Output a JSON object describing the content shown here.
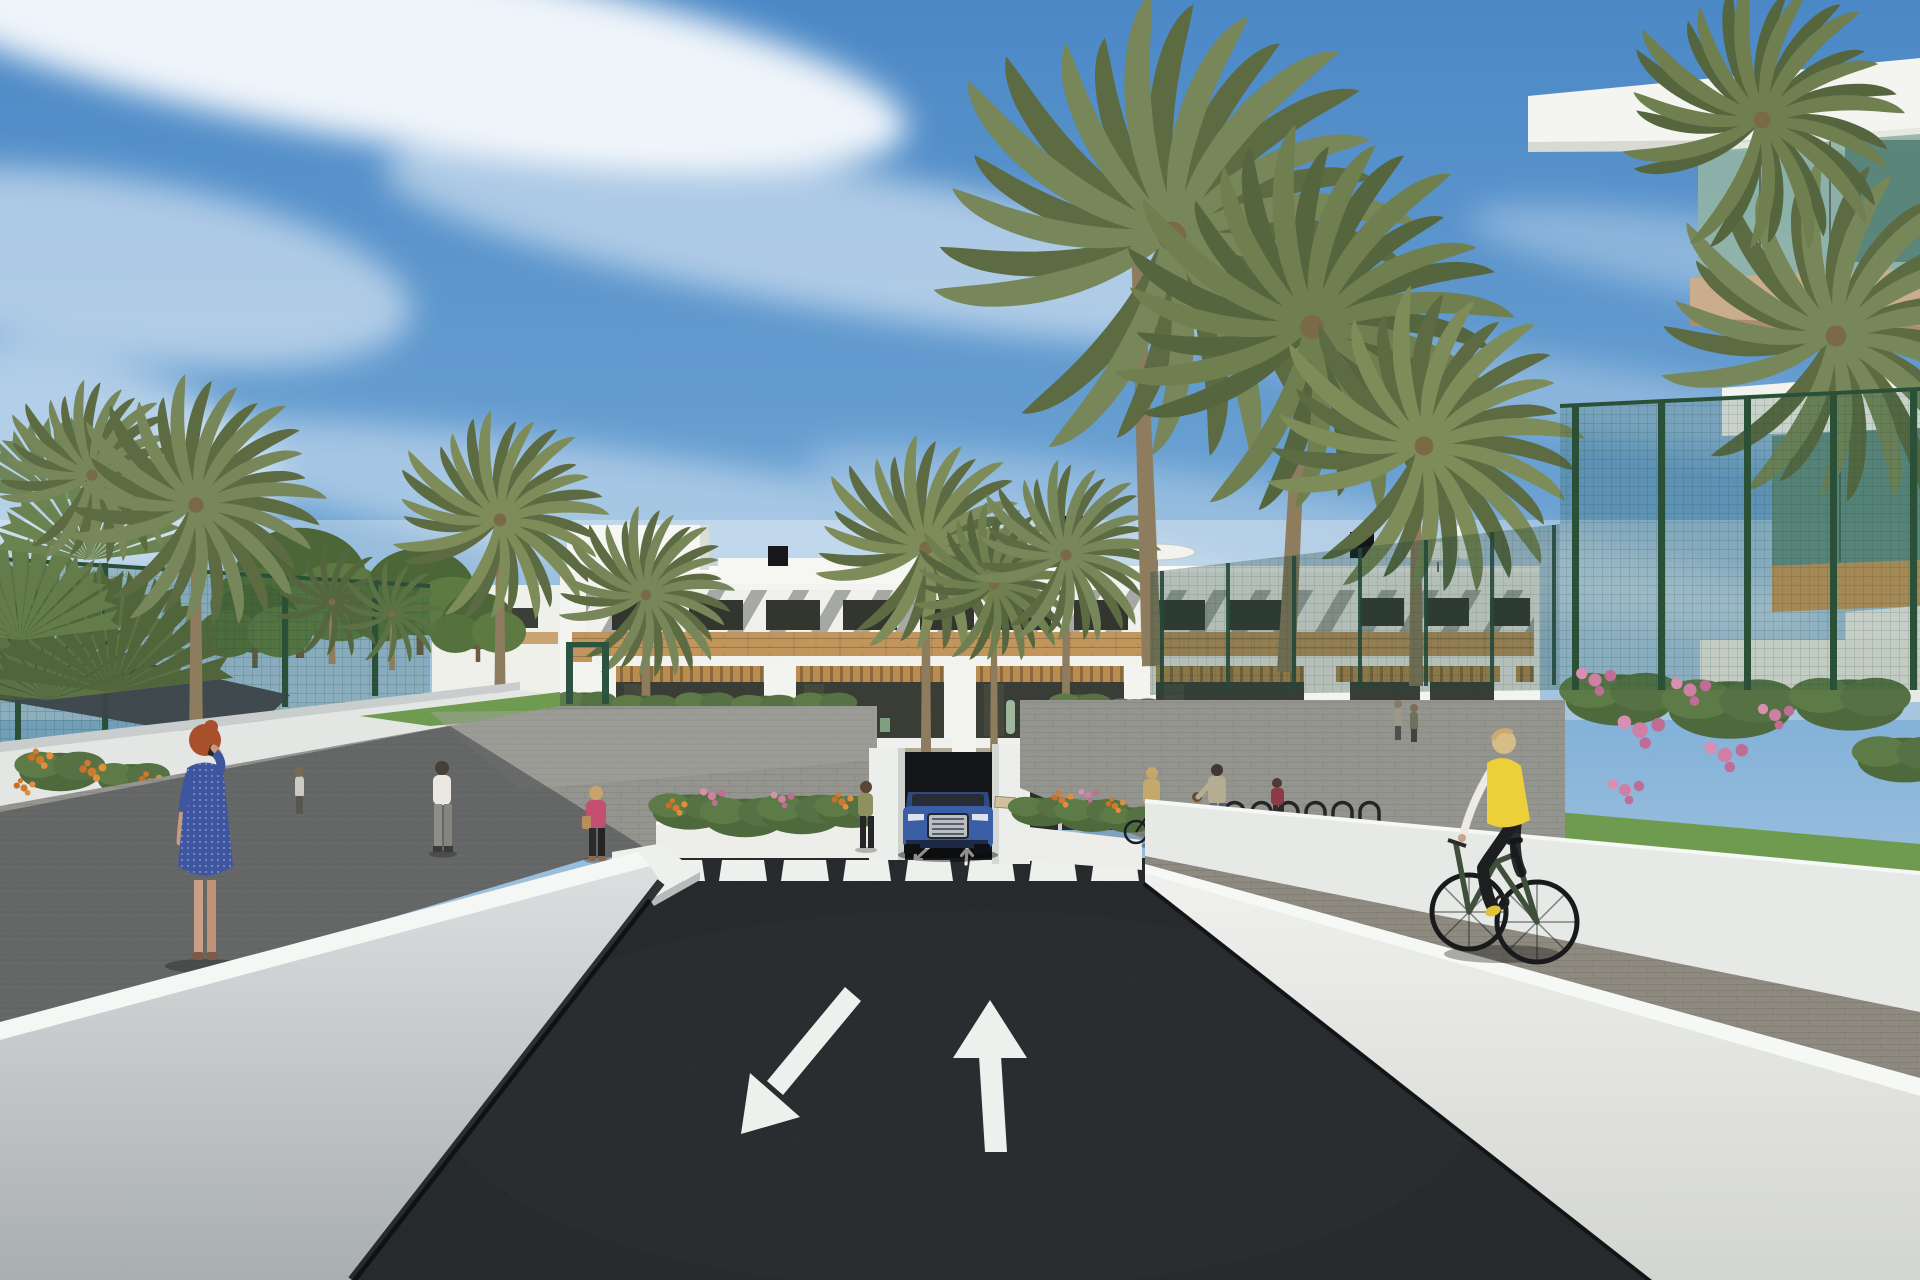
{
  "scene": {
    "sky": {
      "top": "#4b88c6",
      "mid": "#6fa5d4",
      "low": "#abc9e1",
      "horizon": "#e1e9ee",
      "clouds": "#ffffff"
    },
    "building": {
      "facade": "#f3f3ef",
      "wood": "#c2955c",
      "glass": "#33362f",
      "stripe_shadow": "#6d716e",
      "visible_floors": 3
    },
    "road": {
      "asphalt": "#232529",
      "marking": "#eef0ed",
      "crosswalk_stripes": 8,
      "lane_arrows": [
        "down-left",
        "up"
      ],
      "ramp_arrows": [
        "down-left",
        "up"
      ]
    },
    "walls": {
      "face": "#d5d8d9",
      "top": "#f6f8f5"
    },
    "paths": {
      "gray": "#94958f",
      "paver": "#8e8a80",
      "shadow": "#3f4448"
    },
    "greenery": {
      "palm": "#77875a",
      "palm_dark": "#5c6b42",
      "tree": "#52703e",
      "grass": "#6f9b50",
      "fence": "#2c5a3f",
      "bougainvillea": "#c77fa5",
      "marigold": "#d07a2e"
    },
    "sail": "#3c4349",
    "vehicle": {
      "type": "SUV",
      "color": "#3b5fa6"
    },
    "people": [
      {
        "label": "woman-blue-dress",
        "dress": "#3e56a0"
      },
      {
        "label": "man-white-shirt",
        "shirt": "#eae8e1"
      },
      {
        "label": "woman-pink-jacket",
        "jacket": "#c2506e"
      },
      {
        "label": "woman-olive-top",
        "top": "#8f9060"
      },
      {
        "label": "woman-tan-jacket-with-bike",
        "jacket": "#c4a96b"
      },
      {
        "label": "woman-floral-top",
        "top": "#b5ad92"
      },
      {
        "label": "child",
        "top": "#8f8f63"
      },
      {
        "label": "woman-red-top",
        "top": "#8c3a46"
      },
      {
        "label": "cyclist-yellow-vest",
        "vest": "#edd039"
      }
    ]
  }
}
